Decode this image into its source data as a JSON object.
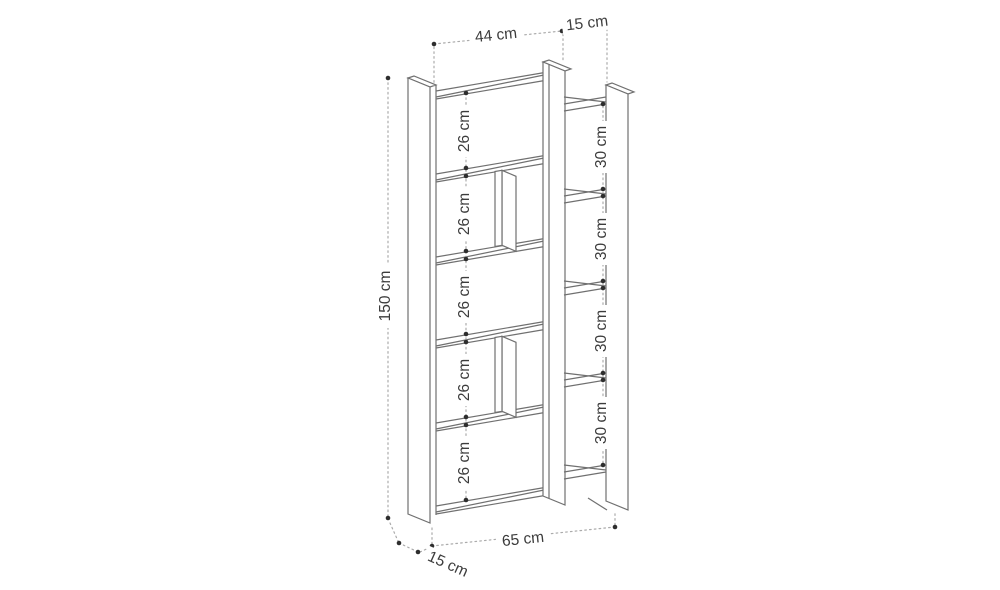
{
  "diagram": {
    "title": "bookshelf-dimension-drawing",
    "units": "cm",
    "colors": {
      "background": "#ffffff",
      "edge_line": "#707070",
      "dimension_line": "#ababab",
      "marker_dot": "#2e2e2e",
      "label_text": "#3c3c3c"
    },
    "dimensions": {
      "height": "150 cm",
      "top_inner_width": "44 cm",
      "top_depth": "15 cm",
      "bottom_total_width": "65 cm",
      "bottom_depth": "15 cm",
      "left_sections": [
        "26 cm",
        "26 cm",
        "26 cm",
        "26 cm",
        "26 cm"
      ],
      "right_sections": [
        "30 cm",
        "30 cm",
        "30 cm",
        "30 cm"
      ]
    }
  }
}
